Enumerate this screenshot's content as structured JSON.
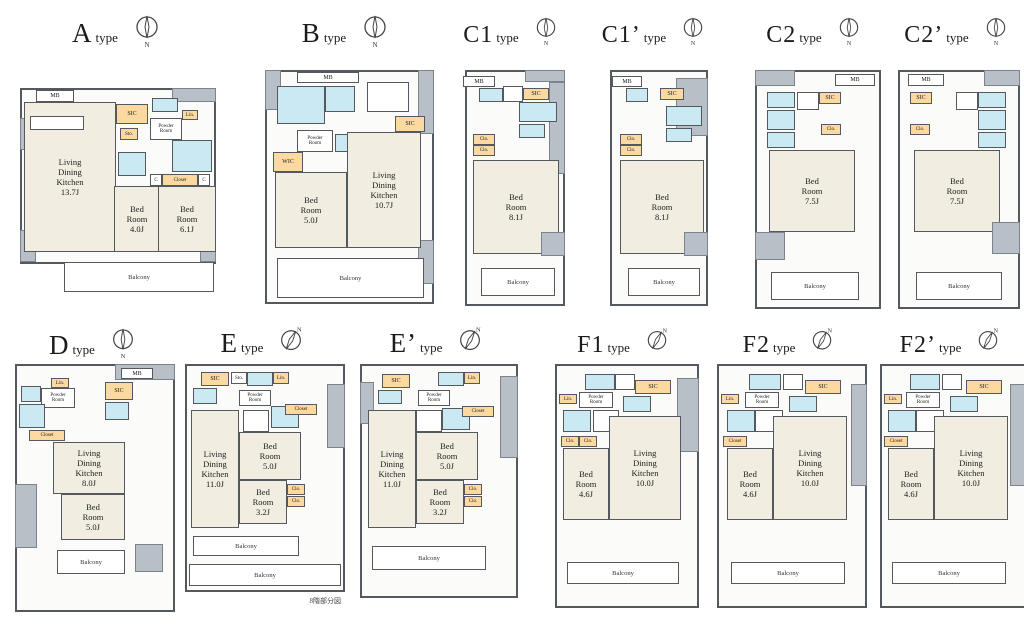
{
  "common": {
    "type_suffix": "type",
    "compass_n": "N",
    "balcony": "Balcony"
  },
  "note": "8階部分図",
  "units": [
    {
      "name": "A",
      "rooms": {
        "ldk": "Living\nDining\nKitchen\n13.7J",
        "bed1": "Bed\nRoom\n4.0J",
        "bed2": "Bed\nRoom\n6.1J"
      },
      "labels": {
        "mb": "MB",
        "sic": "SIC",
        "sto": "Sto.",
        "powder": "Powder\nRoom",
        "lin": "Lin.",
        "closet": "Closet",
        "c": "C"
      }
    },
    {
      "name": "B",
      "rooms": {
        "bed": "Bed\nRoom\n5.0J",
        "ldk": "Living\nDining\nKitchen\n10.7J"
      },
      "labels": {
        "mb": "MB",
        "sic": "SIC",
        "powder": "Powder\nRoom",
        "wic": "WIC"
      }
    },
    {
      "name": "C1",
      "rooms": {
        "bed": "Bed\nRoom\n8.1J"
      },
      "labels": {
        "mb": "MB",
        "sic": "SIC",
        "clo": "Clo."
      }
    },
    {
      "name": "C1’",
      "rooms": {
        "bed": "Bed\nRoom\n8.1J"
      },
      "labels": {
        "mb": "MB",
        "sic": "SIC",
        "clo": "Clo."
      }
    },
    {
      "name": "C2",
      "rooms": {
        "bed": "Bed\nRoom\n7.5J"
      },
      "labels": {
        "mb": "MB",
        "sic": "SIC",
        "clo": "Clo."
      }
    },
    {
      "name": "C2’",
      "rooms": {
        "bed": "Bed\nRoom\n7.5J"
      },
      "labels": {
        "mb": "MB",
        "sic": "SIC",
        "clo": "Clo."
      }
    },
    {
      "name": "D",
      "rooms": {
        "ldk": "Living\nDining\nKitchen\n8.0J",
        "bed": "Bed\nRoom\n5.0J"
      },
      "labels": {
        "mb": "MB",
        "sic": "SIC",
        "lin": "Lin.",
        "powder": "Powder\nRoom",
        "closet": "Closet"
      }
    },
    {
      "name": "E",
      "rooms": {
        "ldk": "Living\nDining\nKitchen\n11.0J",
        "bed1": "Bed\nRoom\n5.0J",
        "bed2": "Bed\nRoom\n3.2J"
      },
      "labels": {
        "sic": "SIC",
        "sto": "Sto.",
        "lin": "Lin.",
        "powder": "Powder\nRoom",
        "closet": "Closet",
        "clo": "Clo."
      }
    },
    {
      "name": "E’",
      "rooms": {
        "ldk": "Living\nDining\nKitchen\n11.0J",
        "bed1": "Bed\nRoom\n5.0J",
        "bed2": "Bed\nRoom\n3.2J"
      },
      "labels": {
        "sic": "SIC",
        "lin": "Lin.",
        "powder": "Powder\nRoom",
        "closet": "Closet",
        "clo": "Clo."
      }
    },
    {
      "name": "F1",
      "rooms": {
        "bed": "Bed\nRoom\n4.6J",
        "ldk": "Living\nDining\nKitchen\n10.0J"
      },
      "labels": {
        "sic": "SIC",
        "lin": "Lin.",
        "powder": "Powder\nRoom",
        "clo": "Clo."
      }
    },
    {
      "name": "F2",
      "rooms": {
        "bed": "Bed\nRoom\n4.6J",
        "ldk": "Living\nDining\nKitchen\n10.0J"
      },
      "labels": {
        "sic": "SIC",
        "lin": "Lin.",
        "powder": "Powder\nRoom",
        "closet": "Closet"
      }
    },
    {
      "name": "F2’",
      "rooms": {
        "bed": "Bed\nRoom\n4.6J",
        "ldk": "Living\nDining\nKitchen\n10.0J"
      },
      "labels": {
        "sic": "SIC",
        "lin": "Lin.",
        "powder": "Powder\nRoom",
        "closet": "Closet"
      }
    }
  ]
}
